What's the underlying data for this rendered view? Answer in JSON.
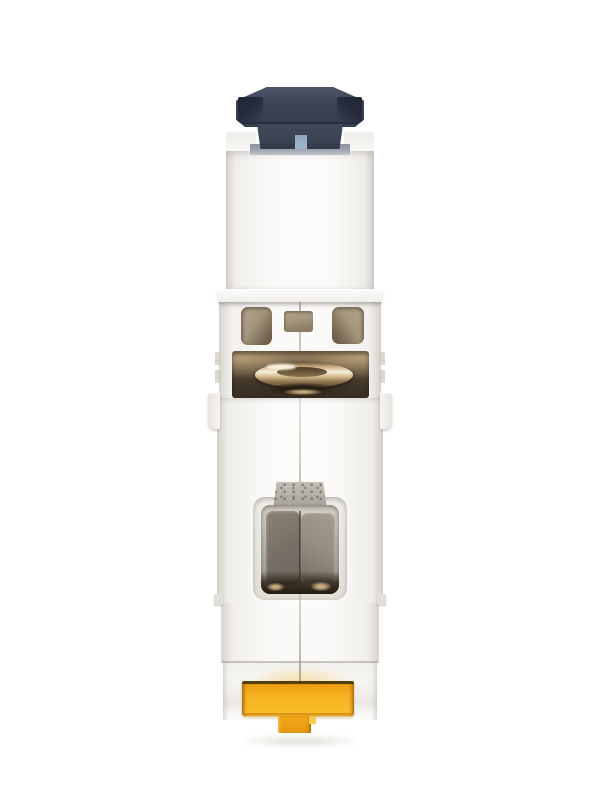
{
  "scene": {
    "subject": "single-pole miniature circuit breaker module, side profile product photo",
    "orientation": "vertical, toggle at top, DIN-rail clip at bottom",
    "background": "plain white"
  },
  "parts": [
    {
      "id": "toggle-actuator",
      "desc": "dark navy switch lever with flared ears and recessed side panels"
    },
    {
      "id": "toggle-indicator",
      "desc": "small light-blue position indicator at lever base"
    },
    {
      "id": "upper-housing",
      "desc": "white molded housing holding the lever"
    },
    {
      "id": "ledge",
      "desc": "protruding white rim below housing"
    },
    {
      "id": "terminal-cutouts",
      "desc": "two rounded cutouts and one small square cutout with tan interior"
    },
    {
      "id": "terminal-clamp",
      "desc": "brass wire clamp visible through rectangular cavity"
    },
    {
      "id": "metal-tab",
      "desc": "speckled gray metal tab above central cavity"
    },
    {
      "id": "contact-pads",
      "desc": "two taupe pads inside recessed central window"
    },
    {
      "id": "din-rail-clip",
      "desc": "yellow T-shaped DIN rail clip at bottom"
    }
  ],
  "colors": {
    "background": "#ffffff",
    "body_light": "#fbfaf8",
    "body_edge": "#d6d2cd",
    "navy": "#3d4456",
    "navy_light": "#4e5569",
    "navy_dark": "#272d3d",
    "indicator_blue": "#a2b7cd",
    "slot_gray": "#9ba2ae",
    "tan_light": "#b5a68d",
    "tan_dark": "#6d5e4a",
    "cavity_tan": "#96805f",
    "cavity_dark": "#362c21",
    "brass_light": "#f7efdc",
    "brass_mid": "#c7ab7e",
    "brass_dark": "#57432e",
    "tab_gray": "#b2aea6",
    "pad_dark": "#6f675d",
    "pad_light": "#968d82",
    "window_shadow": "#251c11",
    "clip_yellow": "#f9ba25",
    "clip_orange": "#ee9d12",
    "clip_outline": "#54400f",
    "clip_under": "#d8870e",
    "ground_shadow": "rgba(160,150,130,0.28)"
  }
}
